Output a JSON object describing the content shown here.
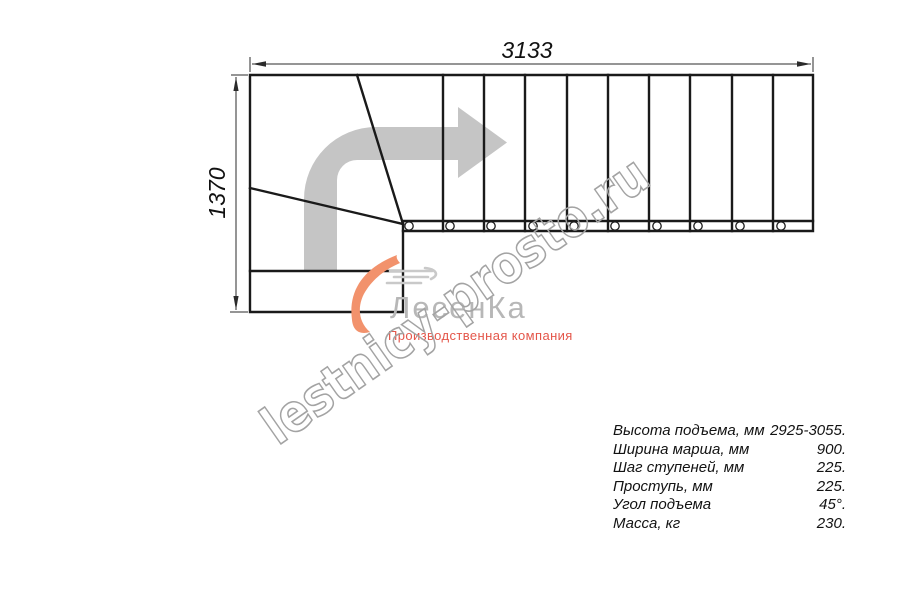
{
  "title": "L-shaped staircase plan drawing",
  "dimensions": {
    "width_mm": "3133",
    "height_mm": "1370"
  },
  "watermark": {
    "text": "lestnicy-prosto.ru"
  },
  "logo": {
    "name": "ЛесенКа",
    "tagline": "Производственная компания",
    "swoosh_color": "#f2926c",
    "tagline_color": "#e4564a"
  },
  "specs": {
    "rows": [
      {
        "label": "Высота подъема, мм",
        "value": "2925-3055."
      },
      {
        "label": "Ширина марша, мм",
        "value": "900."
      },
      {
        "label": "Шаг ступеней, мм",
        "value": "225."
      },
      {
        "label": "Проступь, мм",
        "value": "225."
      },
      {
        "label": "Угол подъема",
        "value": "45°."
      },
      {
        "label": "Масса, кг",
        "value": "230."
      }
    ]
  },
  "stair": {
    "view": "plan (top view)",
    "shape": "L-shaped, 90° turn",
    "straight_treads": 10,
    "winder_treads": 2,
    "starting_step": 1,
    "balusters_shown": 10,
    "turn_arrow": "up then right"
  },
  "colors": {
    "line": "#1a1a1a",
    "direction_arrow": "#c5c5c5",
    "watermark_outline": "#a3a3a3",
    "logo_gray": "#b7b7b7"
  }
}
